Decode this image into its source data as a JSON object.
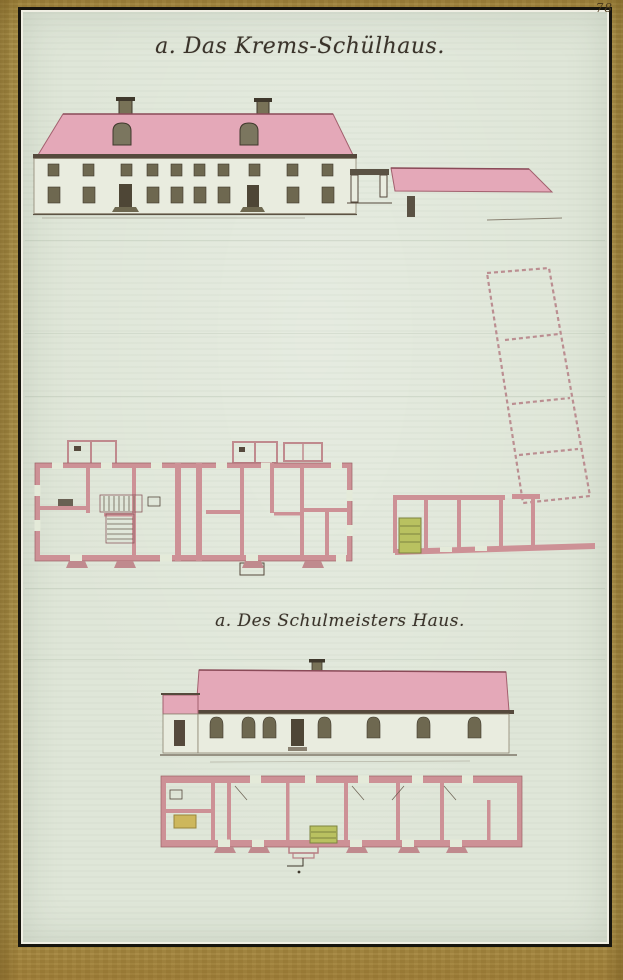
{
  "page": {
    "number": "78"
  },
  "titles": {
    "top": "a. Das Krems-Schülhaus.",
    "bottom": "a. Des Schulmeisters Haus."
  },
  "colors": {
    "border_gold": "#ab9148",
    "paper": "#dfe6d8",
    "frame_ink": "#17150e",
    "roof_pink": "#e4a8b8",
    "roof_edge": "#8a4a58",
    "plan_wall_pink": "#cd9196",
    "dashed_pink": "#bb8e91",
    "ink": "#3f382c",
    "window_olive": "#6e6850",
    "stove_green": "#b9c160",
    "stove_yellow": "#cdb75c"
  }
}
